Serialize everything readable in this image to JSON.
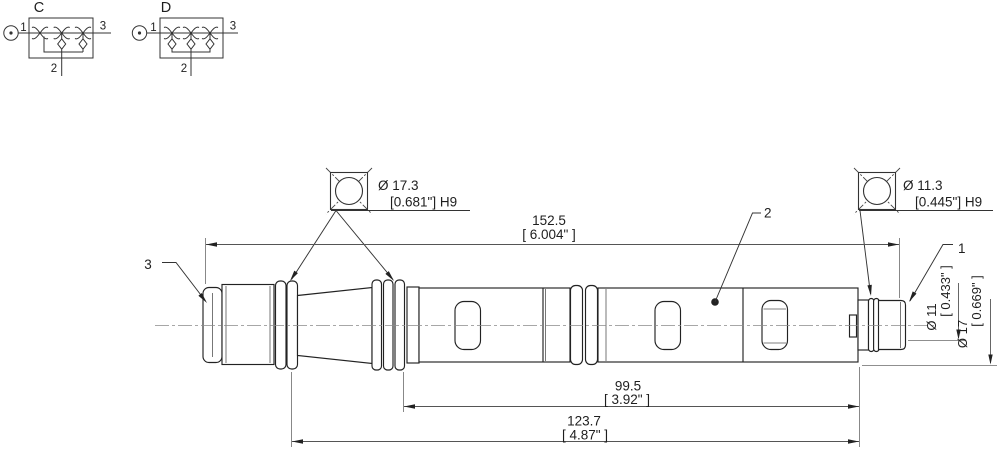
{
  "schematic_c": {
    "title": "C",
    "ports": {
      "p1": "1",
      "p2": "2",
      "p3": "3"
    }
  },
  "schematic_d": {
    "title": "D",
    "ports": {
      "p1": "1",
      "p2": "2",
      "p3": "3"
    }
  },
  "callouts": {
    "c1": "1",
    "c2": "2",
    "c3": "3"
  },
  "dims": {
    "overall": {
      "mm": "152.5",
      "inch": "[ 6.004\" ]"
    },
    "len_mid": {
      "mm": "99.5",
      "inch": "[ 3.92\" ]"
    },
    "len_long": {
      "mm": "123.7",
      "inch": "[ 4.87\" ]"
    },
    "bore_left": {
      "dia": "Ø 17.3",
      "tol": "[0.681\"] H9"
    },
    "bore_right": {
      "dia": "Ø 11.3",
      "tol": "[0.445\"] H9"
    },
    "dia_small": {
      "mm": "Ø 11",
      "inch": "[ 0.433\" ]"
    },
    "dia_large": {
      "mm": "Ø 17",
      "inch": "[ 0.669\" ]"
    }
  }
}
